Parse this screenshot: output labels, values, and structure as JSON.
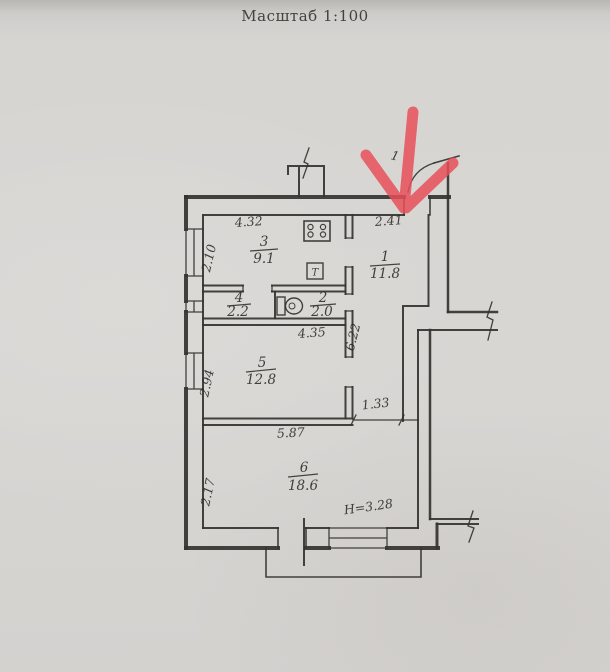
{
  "title": "Масштаб 1:100",
  "plan": {
    "rooms": [
      {
        "number": "3",
        "area": "9.1"
      },
      {
        "number": "1",
        "area": "11.8"
      },
      {
        "number": "4",
        "area": "2.2"
      },
      {
        "number": "2",
        "area": "2.0"
      },
      {
        "number": "5",
        "area": "12.8"
      },
      {
        "number": "6",
        "area": "18.6"
      }
    ],
    "dimensions": {
      "kitchen_width": "4.32",
      "hall_width": "2.41",
      "kitchen_window": "2.10",
      "room5_top": "4.35",
      "room5_window": "2.94",
      "corridor_length": "6.22",
      "corridor_opening": "1.33",
      "room6_width": "5.87",
      "room6_left": "2.17",
      "ceiling_height": "H=3.28"
    },
    "annotations": {
      "entry_mark": "1"
    },
    "fixtures": {
      "towel_dryer_label": "Т"
    },
    "colors": {
      "arrow": "#e84f58",
      "ink": "#35332f",
      "paper": "#d6d4d1"
    }
  }
}
